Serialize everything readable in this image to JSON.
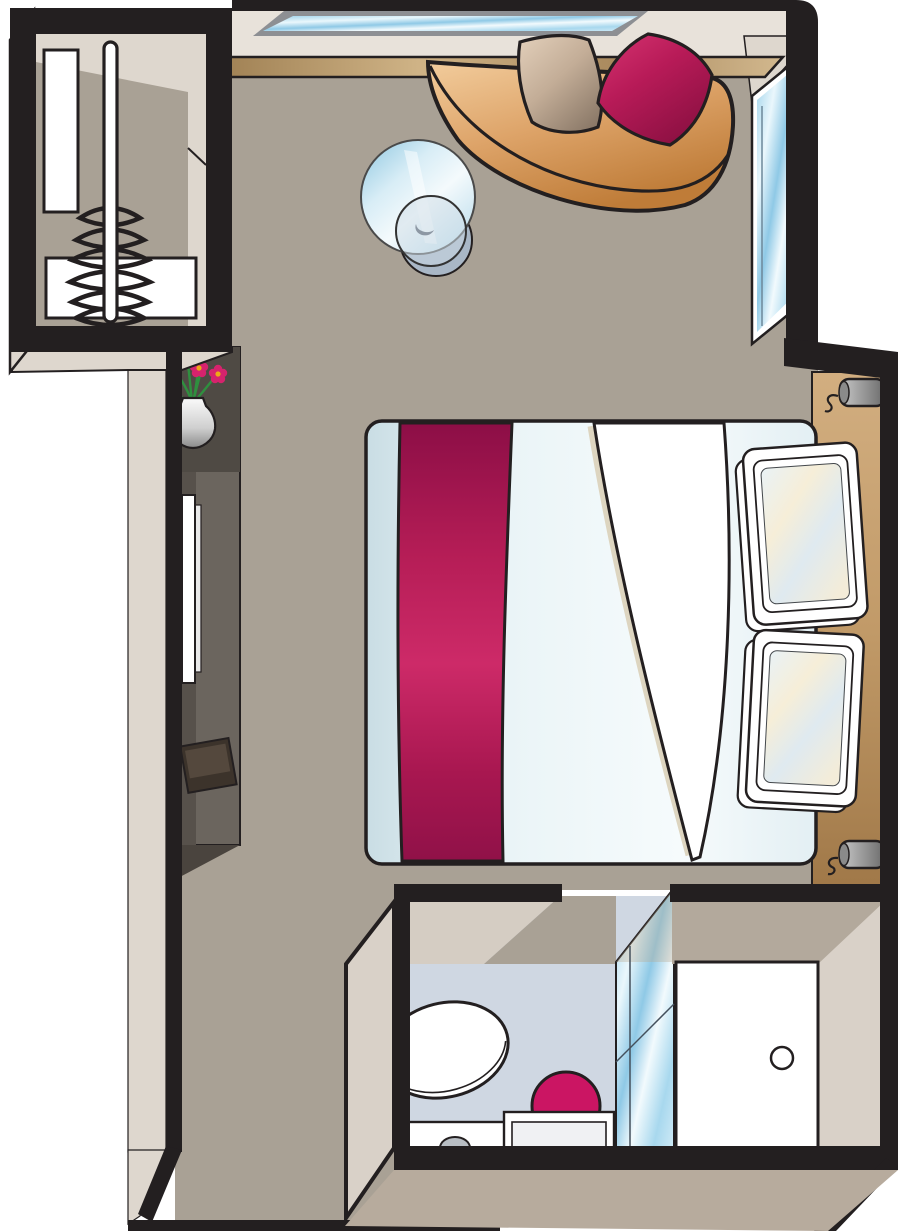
{
  "meta": {
    "title": "Stateroom cabin floor plan (top-down illustration)",
    "style": "vector illustration, thick black walls, beveled 3D wall faces",
    "canvas": {
      "width": 900,
      "height": 1231
    },
    "text_on_image": "none"
  },
  "palette": {
    "outline": "#231f20",
    "floor": "#a9a195",
    "wall_face": "#ded7ce",
    "wall_face_mid": "#cac0b5",
    "wall_face_dark": "#b7ab9d",
    "sill_cream": "#e8e2da",
    "window_frame": "#8d8f93",
    "glass_blue": "#9ed2ea",
    "ledge_tan": "#c9ad80",
    "sofa_tan": "#dda368",
    "cushion_tan": "#c3ad97",
    "accent_magenta": "#c2195c",
    "accent_magenta_dark": "#8c1042",
    "duvet_blue": "#e8f3f6",
    "sheet_shadow": "#ddd5c0",
    "headboard_tan": "#c19a68",
    "lamp_gray": "#9a9a9a",
    "desk_dark": "#6b655e",
    "desk_darker": "#57514b",
    "stool_brown": "#3c332b",
    "bath_floor": "#cfd7e2",
    "sink_bowl": "#cb1563",
    "flower_pink": "#d6236d",
    "flower_center": "#eda816",
    "stem_green": "#2f8f3f",
    "white": "#ffffff"
  },
  "rooms": [
    {
      "id": "main-cabin",
      "label": "Main cabin / bedroom",
      "furniture": [
        "double-bed",
        "bed-runner",
        "sheet-fold",
        "pillows (2)",
        "curved-sofa",
        "cushions (2: tan, magenta)",
        "round-glass-table",
        "vanity-desk",
        "stool",
        "vase-with-flowers (5 blooms)",
        "top-window",
        "console-ledge",
        "tall-side-window",
        "headboard-panel",
        "wall-lamps (2)"
      ]
    },
    {
      "id": "closet",
      "label": "Wardrobe closet (top-left)",
      "furniture": [
        "hanging-rail",
        "coat-hangers (6)",
        "tall-shelf-panel",
        "drawer-box"
      ]
    },
    {
      "id": "bathroom",
      "label": "Bathroom (bottom)",
      "furniture": [
        "toilet",
        "sink-counter",
        "magenta-sink-bowl",
        "low-shelf",
        "shower-glass-panel"
      ]
    },
    {
      "id": "entry",
      "label": "Entry vestibule (bottom-right)",
      "furniture": [
        "cabin-door",
        "door-knob"
      ]
    }
  ],
  "counts": {
    "hangers": 6,
    "bed_pillows": 2,
    "sofa_cushions": 2,
    "wall_lamps": 2,
    "flowers": 5,
    "windows": 3
  }
}
